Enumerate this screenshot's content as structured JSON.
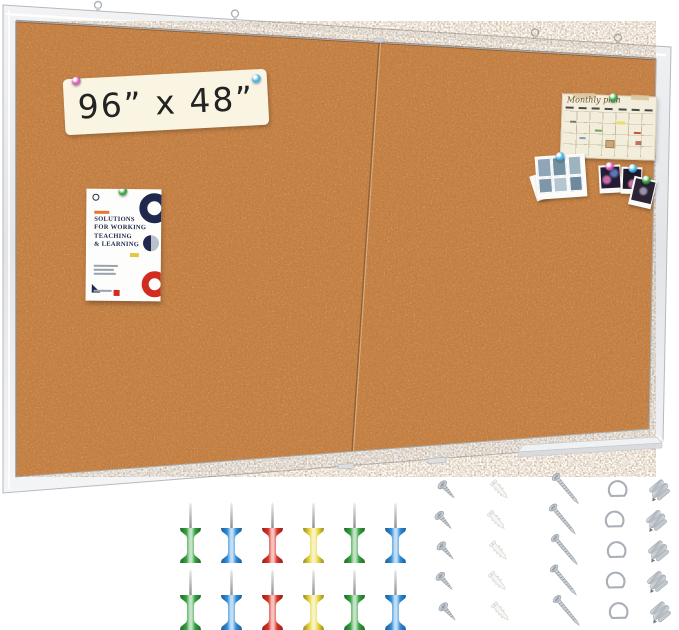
{
  "palette": {
    "green": "#33a23e",
    "blue": "#2f8fdd",
    "red": "#dd3327",
    "yellow": "#e8d83c",
    "pink": "#d859b8",
    "skyblue": "#46b3e6",
    "cork": "#cc8244",
    "frame": "#e9eaec",
    "navy": "#20294d",
    "poster_red": "#d22b20",
    "poster_yellow": "#e3c93e",
    "brand_orange": "#e8762e"
  },
  "board": {
    "size_label": "96” x 48”",
    "panels": 2,
    "hanging_hooks": 4
  },
  "poster": {
    "headline_lines": [
      "SOLUTIONS",
      "FOR WORKING",
      "TEACHING",
      "& LEARNING"
    ]
  },
  "calendar": {
    "title": "Monthly plan"
  },
  "pushpins": {
    "rows": 2,
    "colors_per_row": [
      "green",
      "blue",
      "red",
      "yellow",
      "green",
      "blue"
    ]
  },
  "pinned_item_pins": {
    "size_label": [
      "pink",
      "skyblue"
    ],
    "poster": [
      "green"
    ],
    "calendar": [
      "green"
    ],
    "photo_collage": [
      "skyblue"
    ],
    "polaroids": [
      "pink",
      "skyblue",
      "green"
    ]
  },
  "hardware": [
    {
      "id": "short-screws",
      "label": "self-tapping screws",
      "count": 5
    },
    {
      "id": "wall-anchors",
      "label": "plastic wall anchors",
      "count": 5
    },
    {
      "id": "long-screws",
      "label": "long screws",
      "count": 5
    },
    {
      "id": "d-rings",
      "label": "d-ring hangers",
      "count": 5
    },
    {
      "id": "metal-clips",
      "label": "metal mounting clips",
      "count": 5
    }
  ]
}
